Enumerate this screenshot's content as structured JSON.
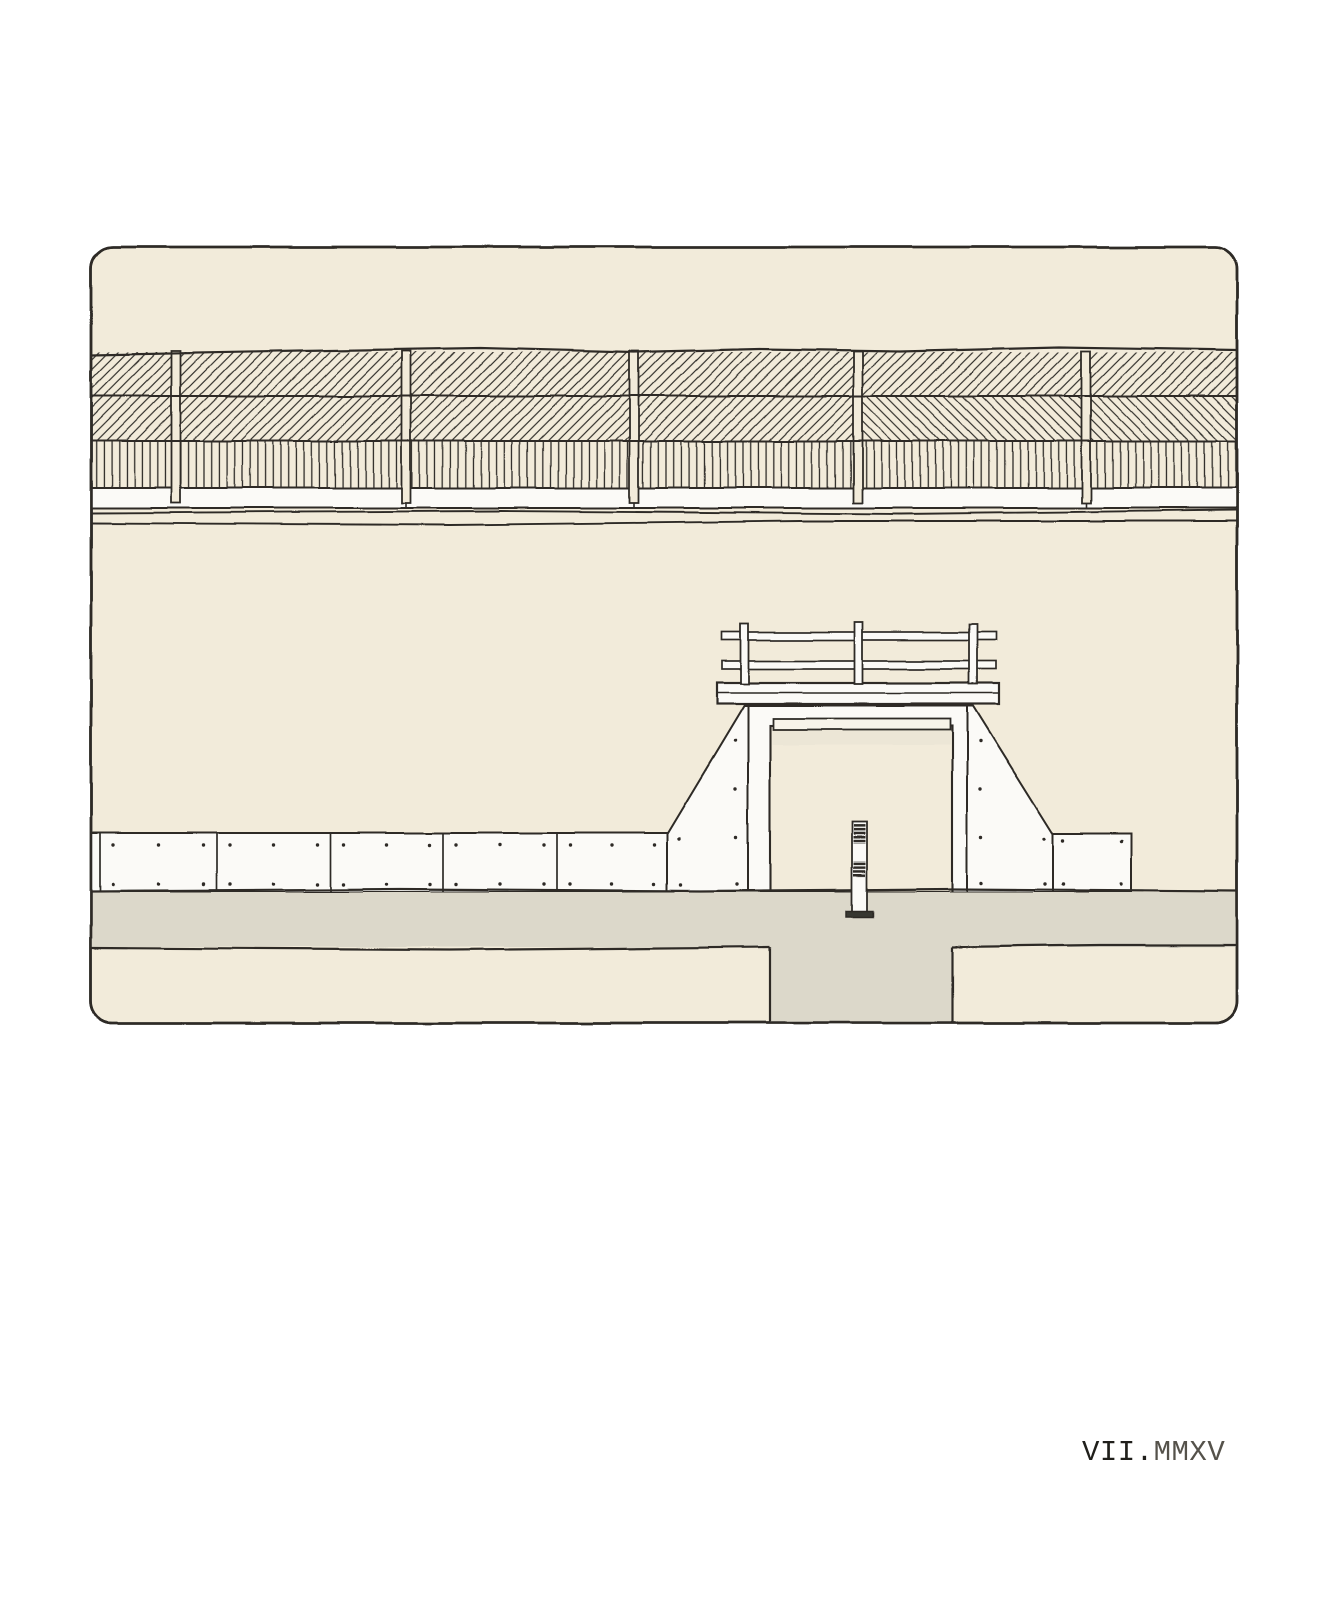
{
  "caption": {
    "month_roman": "VII.",
    "year_roman": "MMXV",
    "full_text": "VII.MMXV"
  },
  "palette": {
    "paper": "#ffffff",
    "canvas": "#f2ebda",
    "sidewalk": "#dcd8ca",
    "panel": "#fbfaf7",
    "ink": "#2d2c28",
    "shade": "#e8e2d3",
    "bollard_base": "#383731",
    "caption_dark": "#201f1b",
    "caption_gray": "#55524b"
  }
}
